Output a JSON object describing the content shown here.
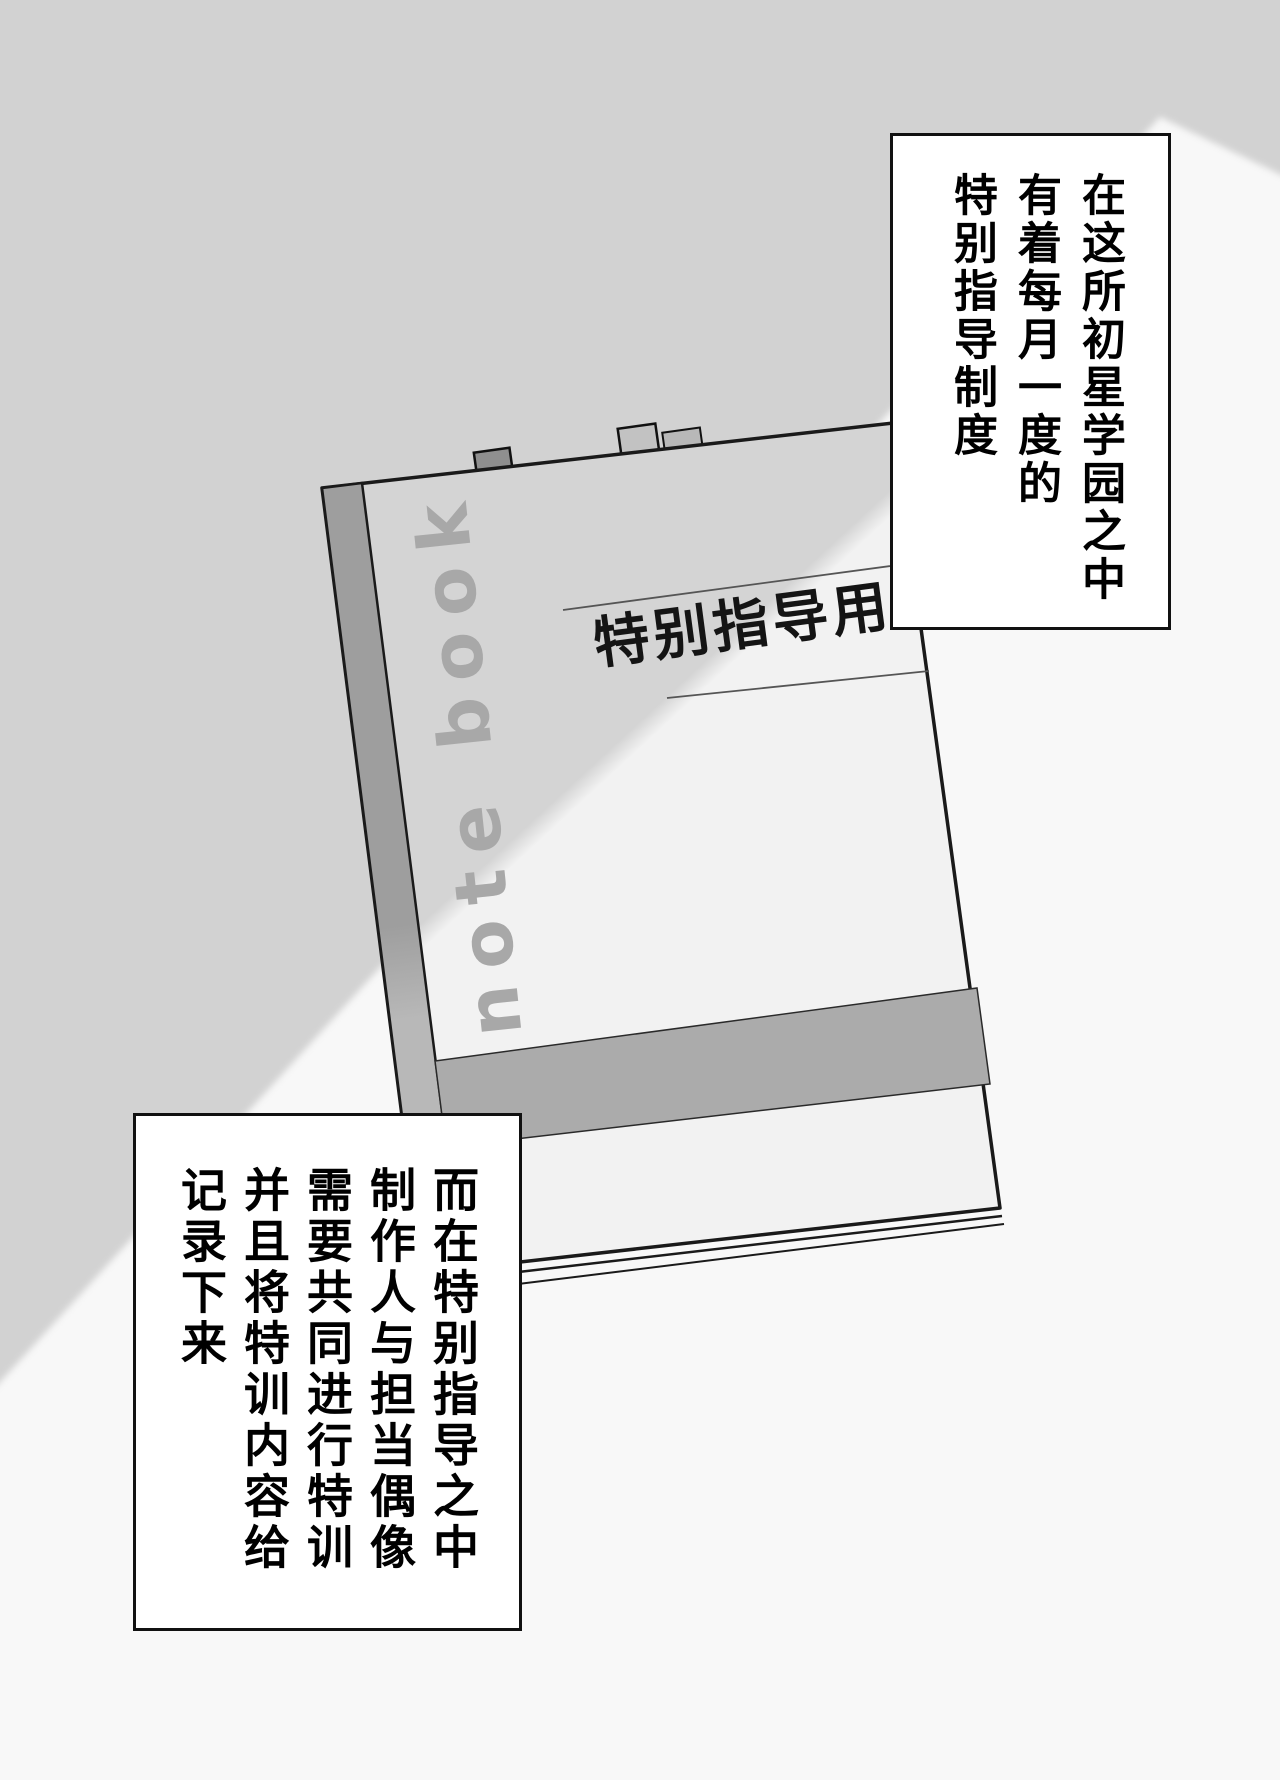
{
  "page_type": "manga-page",
  "colors": {
    "background_gray": "#d2d2d2",
    "light_beam_white": "#f8f8f8",
    "cover_gray": "#d4d4d4",
    "cover_highlight": "#f2f2f2",
    "spine_gray": "#9e9e9e",
    "spine_gray_light": "#b8b8b8",
    "stripe_gray": "#ababab",
    "tab_dark_gray": "#8f8f8f",
    "tab_light_gray": "#c2c2c2",
    "spine_text_gray": "#a8a8a8",
    "outline_black": "#1a1a1a"
  },
  "caption_top": {
    "lines": [
      "在这所初星学园之中",
      "有着每月一度的",
      "特别指导制度"
    ]
  },
  "caption_bottom": {
    "lines": [
      "而在特别指导之中",
      "制作人与担当偶像",
      "需要共同进行特训",
      "并且将特训内容给",
      "记录下来"
    ]
  },
  "notebook": {
    "spine_text": "note book",
    "label_text": "特别指导用"
  }
}
